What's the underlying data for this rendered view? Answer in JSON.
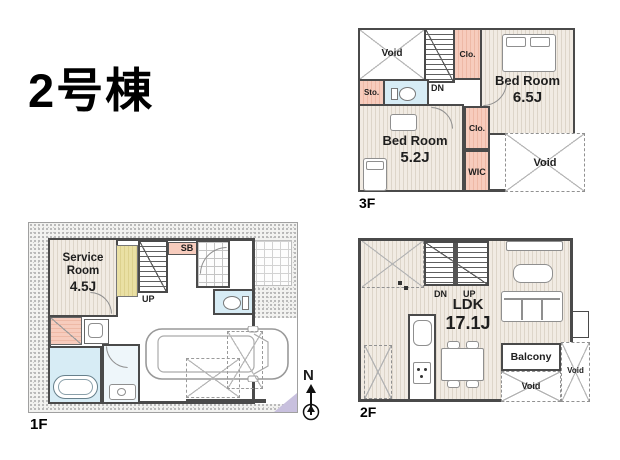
{
  "title": "2号棟",
  "compass": {
    "north": "N"
  },
  "colors": {
    "wall": "#4a4a4a",
    "closet_pink": "#f7ccbd",
    "water_blue": "#d7ecf5",
    "floor_beige": "#f1ebe3",
    "tatami_yellow": "#eae0a4",
    "accent_purple": "#c8c0de",
    "line_gray": "#b5b5b5",
    "text_dark": "#1e1e1e"
  },
  "floors": {
    "f3": {
      "label": "3F",
      "void_top": "Void",
      "clo_top": "Clo.",
      "bed65_name": "Bed Room",
      "bed65_size": "6.5J",
      "sto": "Sto.",
      "dn": "DN",
      "bed52_name": "Bed Room",
      "bed52_size": "5.2J",
      "clo_mid": "Clo.",
      "wic": "WIC",
      "void_br": "Void"
    },
    "f2": {
      "label": "2F",
      "dn": "DN",
      "up": "UP",
      "ldk_name": "LDK",
      "ldk_size": "17.1J",
      "balcony": "Balcony",
      "void_bottom": "Void",
      "void_right": "Void"
    },
    "f1": {
      "label": "1F",
      "service_name": "Service Room",
      "service_size": "4.5J",
      "sb": "SB",
      "up": "UP"
    }
  }
}
